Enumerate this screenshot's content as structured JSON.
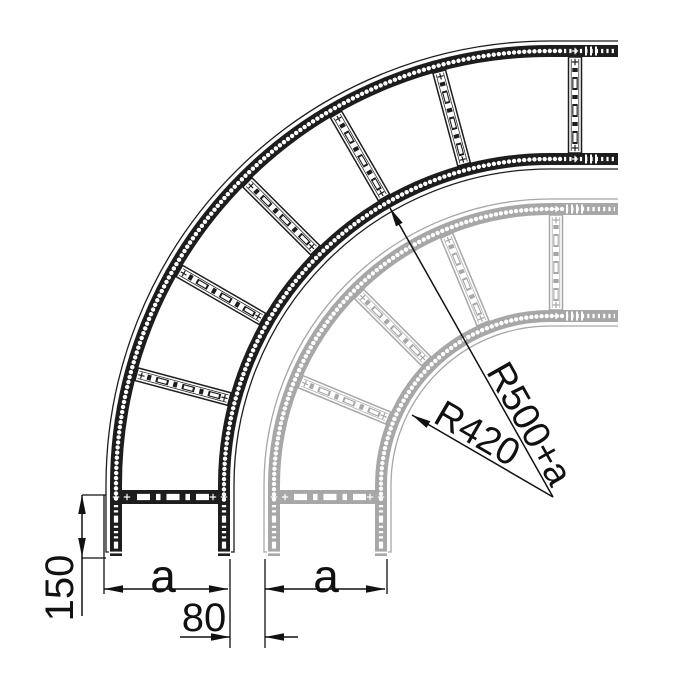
{
  "labels": {
    "dim_150": "150",
    "dim_a_black": "a",
    "dim_80": "80",
    "dim_a_gray": "a",
    "radius_outer": "R500+a",
    "radius_inner": "R420"
  },
  "colors": {
    "foreground_ladder": "#1d1d1d",
    "background_ladder": "#a7a7a7",
    "annotation": "#111111",
    "background": "#ffffff"
  },
  "drawing": {
    "width": 691,
    "height": 683,
    "center": {
      "x": 550,
      "y": 485
    },
    "ladders": [
      {
        "id": "gray",
        "color_key": "background_ladder",
        "outer_band": [
          270,
          282
        ],
        "inner_band": [
          163,
          175
        ],
        "outer_contour": 286,
        "inner_contour": 159,
        "end_x": 618,
        "end_y": 556,
        "arc_rung_angles": [
          112.5,
          135,
          157.5
        ],
        "right_rung_x": 556,
        "bottom_rung_y": 497,
        "filled_right_from": 564,
        "filled_bottom_from": 503,
        "end_bars_x": [
          567,
          572,
          577,
          582
        ]
      },
      {
        "id": "black",
        "color_key": "foreground_ladder",
        "outer_band": [
          428,
          440
        ],
        "inner_band": [
          320,
          332
        ],
        "outer_contour": 444,
        "inner_contour": 316,
        "end_x": 618,
        "end_y": 556,
        "arc_rung_angles": [
          105,
          120,
          135,
          150,
          165
        ],
        "right_rung_x": 575,
        "bottom_rung_y": 497,
        "filled_right_from": 562,
        "filled_bottom_from": 503,
        "end_bars_x": [
          586,
          591,
          596
        ]
      }
    ],
    "dimensions": {
      "height-150": {
        "lines": [
          [
            82,
            495,
            82,
            616
          ]
        ],
        "arrows": [
          [
            82,
            495,
            -90
          ],
          [
            82,
            557,
            90
          ]
        ],
        "exts": [
          [
            82,
            495,
            106,
            495
          ],
          [
            82,
            558,
            106,
            558
          ]
        ],
        "label_key": "dim_150",
        "label_pos": [
          60,
          588
        ],
        "label_rotate": -90,
        "label_class": "dim-num"
      },
      "width-a-black": {
        "lines": [
          [
            104,
            589,
            228,
            589
          ]
        ],
        "arrows": [
          [
            104,
            589,
            180
          ],
          [
            228,
            589,
            0
          ]
        ],
        "exts": [
          [
            104,
            495,
            104,
            594
          ],
          [
            230,
            559,
            230,
            648
          ]
        ],
        "label_key": "dim_a_black",
        "label_pos": [
          163,
          576
        ],
        "label_rotate": 0,
        "label_class": "dim-a"
      },
      "offset-80": {
        "lines": [
          [
            180,
            637,
            230,
            637
          ],
          [
            265,
            637,
            298,
            637
          ]
        ],
        "arrows": [
          [
            230,
            637,
            0
          ],
          [
            265,
            637,
            180
          ]
        ],
        "exts": [
          [
            265,
            559,
            265,
            648
          ]
        ],
        "label_key": "dim_80",
        "label_pos": [
          204,
          618
        ],
        "label_rotate": 0,
        "label_class": "dim-num"
      },
      "width-a-gray": {
        "lines": [
          [
            265,
            589,
            385,
            589
          ]
        ],
        "arrows": [
          [
            265,
            589,
            180
          ],
          [
            385,
            589,
            0
          ]
        ],
        "exts": [
          [
            387,
            559,
            387,
            594
          ]
        ],
        "label_key": "dim_a_gray",
        "label_pos": [
          326,
          576
        ],
        "label_rotate": 0,
        "label_class": "dim-a"
      },
      "radius-outer": {
        "lines": [
          [
            553,
            497,
            390,
            208
          ]
        ],
        "arrows": [
          [
            390,
            208,
            240.6
          ]
        ],
        "exts": [],
        "label_key": "radius_outer",
        "label_pos": [
          529,
          424
        ],
        "label_rotate": 60.6,
        "label_class": "dim-radius"
      },
      "radius-inner": {
        "lines": [
          [
            553,
            497,
            412,
            415
          ]
        ],
        "arrows": [
          [
            412,
            415,
            210.2
          ]
        ],
        "exts": [],
        "label_key": "radius_inner",
        "label_pos": [
          477,
          434
        ],
        "label_rotate": 30.2,
        "label_class": "dim-radius"
      }
    }
  }
}
